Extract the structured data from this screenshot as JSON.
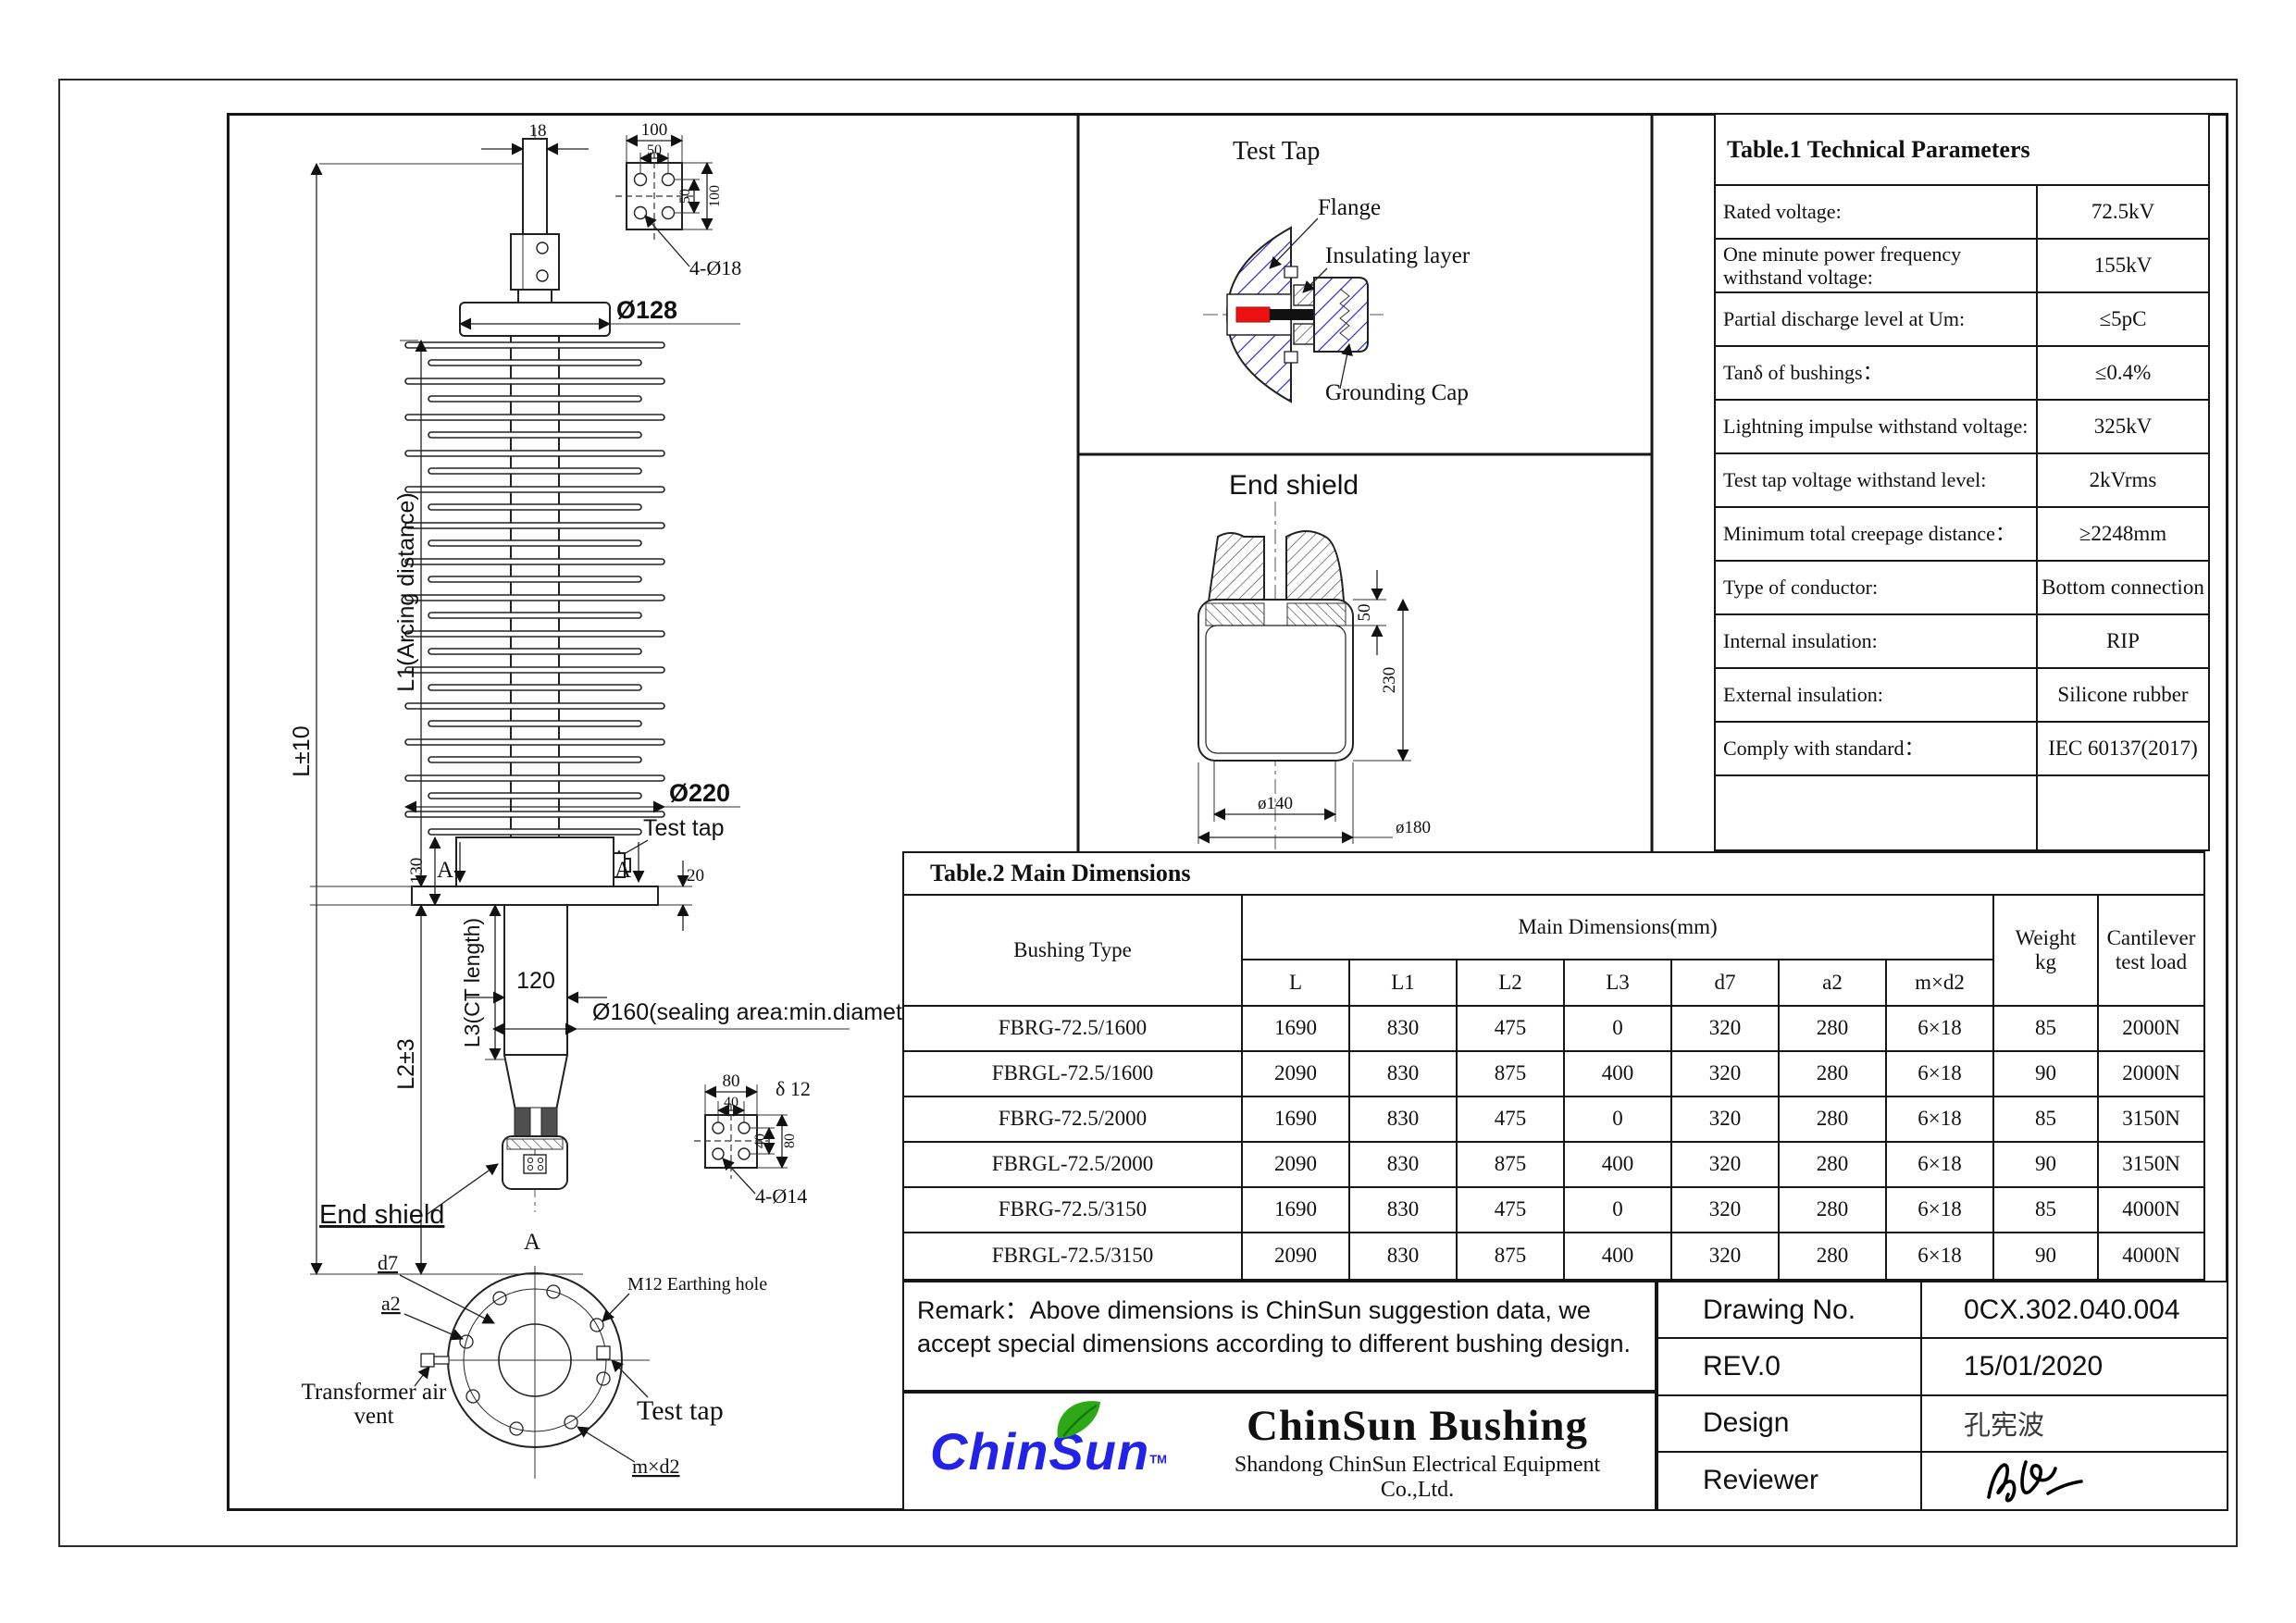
{
  "colors": {
    "line_black": "#161616",
    "hatch_blue": "#1b1be0",
    "conductor_red": "#ee1111",
    "logo_blue": "#2323e8",
    "leaf_green": "#2ea816"
  },
  "drawing": {
    "main_view": {
      "dims": {
        "d18": "18",
        "L": "L±10",
        "L1": "L1(Arcing distance)",
        "L2": "L2±3",
        "L3": "L3(CT length)",
        "dia128": "Ø128",
        "dia220": "Ø220",
        "d130": "130",
        "d20": "20",
        "d120": "120",
        "dia160": "Ø160(sealing area:min.diameter)"
      },
      "labels": {
        "test_tap": "Test tap",
        "end_shield": "End shield",
        "section_a_left": "A",
        "section_a_right": "A",
        "section_mark": "A"
      },
      "top_bolt_detail": {
        "d100": "100",
        "d50": "50",
        "d50v": "50",
        "d100v": "100",
        "holes": "4-Ø18"
      },
      "bottom_bolt_detail": {
        "d80": "80",
        "d40": "40",
        "d40v": "40",
        "d80v": "80",
        "thickness": "δ 12",
        "holes": "4-Ø14"
      },
      "flange_section": {
        "d7": "d7",
        "a2": "a2",
        "air_vent_1": "Transformer air",
        "air_vent_2": "vent",
        "earthing": "M12 Earthing hole",
        "test_tap": "Test tap",
        "mxd2": "m×d2"
      }
    },
    "test_tap_view": {
      "title": "Test Tap",
      "flange": "Flange",
      "insulating_layer": "Insulating layer",
      "grounding_cap": "Grounding Cap"
    },
    "end_shield_view": {
      "title": "End shield",
      "d50": "50",
      "d230": "230",
      "dia140": "ø140",
      "dia180": "ø180"
    }
  },
  "table1": {
    "title": "Table.1  Technical Parameters",
    "rows": [
      {
        "label": "Rated voltage:",
        "value": "72.5kV"
      },
      {
        "label": "One minute power frequency withstand voltage:",
        "value": "155kV"
      },
      {
        "label": "Partial discharge level at Um:",
        "value": "≤5pC"
      },
      {
        "label": "Tanδ of bushings：",
        "value": "≤0.4%"
      },
      {
        "label": "Lightning impulse withstand voltage:",
        "value": "325kV"
      },
      {
        "label": "Test tap voltage withstand level:",
        "value": "2kVrms"
      },
      {
        "label": "Minimum total creepage distance：",
        "value": "≥2248mm"
      },
      {
        "label": "Type of conductor:",
        "value": "Bottom connection"
      },
      {
        "label": "Internal insulation:",
        "value": "RIP"
      },
      {
        "label": "External insulation:",
        "value": "Silicone rubber"
      },
      {
        "label": "Comply with standard：",
        "value": "IEC 60137(2017)"
      }
    ]
  },
  "table2": {
    "title": "Table.2 Main Dimensions",
    "header": {
      "bushing_type": "Bushing Type",
      "group": "Main Dimensions(mm)",
      "cols": [
        "L",
        "L1",
        "L2",
        "L3",
        "d7",
        "a2",
        "m×d2"
      ],
      "weight_l1": "Weight",
      "weight_l2": "kg",
      "load": "Cantilever test load"
    },
    "rows": [
      {
        "cells": [
          "FBRG-72.5/1600",
          "1690",
          "830",
          "475",
          "0",
          "320",
          "280",
          "6×18",
          "85",
          "2000N"
        ]
      },
      {
        "cells": [
          "FBRGL-72.5/1600",
          "2090",
          "830",
          "875",
          "400",
          "320",
          "280",
          "6×18",
          "90",
          "2000N"
        ]
      },
      {
        "cells": [
          "FBRG-72.5/2000",
          "1690",
          "830",
          "475",
          "0",
          "320",
          "280",
          "6×18",
          "85",
          "3150N"
        ]
      },
      {
        "cells": [
          "FBRGL-72.5/2000",
          "2090",
          "830",
          "875",
          "400",
          "320",
          "280",
          "6×18",
          "90",
          "3150N"
        ]
      },
      {
        "cells": [
          "FBRG-72.5/3150",
          "1690",
          "830",
          "475",
          "0",
          "320",
          "280",
          "6×18",
          "85",
          "4000N"
        ]
      },
      {
        "cells": [
          "FBRGL-72.5/3150",
          "2090",
          "830",
          "875",
          "400",
          "320",
          "280",
          "6×18",
          "90",
          "4000N"
        ]
      }
    ]
  },
  "remark": {
    "text": "Remark：Above dimensions is ChinSun suggestion data, we accept special dimensions according to different bushing design."
  },
  "brand": {
    "logo": "ChinSun",
    "tm": "TM",
    "name": "ChinSun Bushing",
    "company": "Shandong ChinSun Electrical Equipment Co.,Ltd."
  },
  "title_block": {
    "drawing_no_label": "Drawing No.",
    "drawing_no": "0CX.302.040.004",
    "rev": "REV.0",
    "date": "15/01/2020",
    "design_label": "Design",
    "designer": "孔宪波",
    "reviewer_label": "Reviewer"
  }
}
